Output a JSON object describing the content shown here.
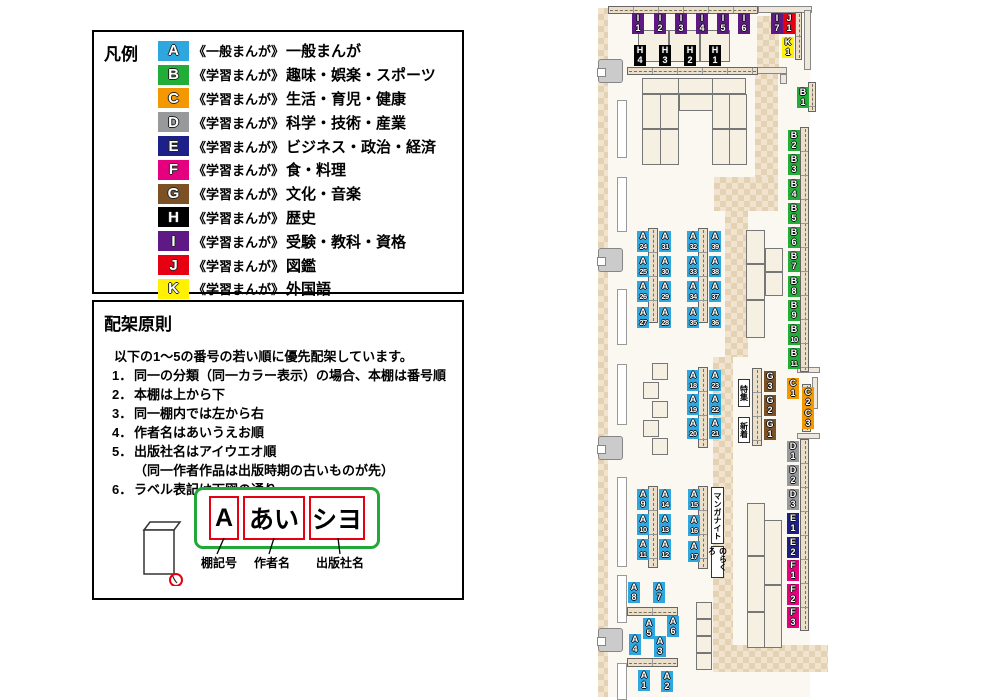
{
  "legend": {
    "title": "凡例",
    "items": [
      {
        "code": "A",
        "color": "#2EA7E0",
        "series": "《一般まんが》",
        "label": "一般まんが"
      },
      {
        "code": "B",
        "color": "#22AC38",
        "series": "《学習まんが》",
        "label": "趣味・娯楽・スポーツ"
      },
      {
        "code": "C",
        "color": "#F39800",
        "series": "《学習まんが》",
        "label": "生活・育児・健康"
      },
      {
        "code": "D",
        "color": "#98999A",
        "series": "《学習まんが》",
        "label": "科学・技術・産業"
      },
      {
        "code": "E",
        "color": "#1D2088",
        "series": "《学習まんが》",
        "label": "ビジネス・政治・経済"
      },
      {
        "code": "F",
        "color": "#E4007F",
        "series": "《学習まんが》",
        "label": "食・料理"
      },
      {
        "code": "G",
        "color": "#7D5126",
        "series": "《学習まんが》",
        "label": "文化・音楽"
      },
      {
        "code": "H",
        "color": "#000000",
        "series": "《学習まんが》",
        "label": "歴史"
      },
      {
        "code": "I",
        "color": "#5F1985",
        "series": "《学習まんが》",
        "label": "受験・教科・資格"
      },
      {
        "code": "J",
        "color": "#E60012",
        "series": "《学習まんが》",
        "label": "図鑑"
      },
      {
        "code": "K",
        "color": "#FFF100",
        "series": "《学習まんが》",
        "label": "外国語"
      }
    ]
  },
  "principles": {
    "title": "配架原則",
    "intro": "以下の1～5の番号の若い順に優先配架しています。",
    "rules": [
      {
        "num": "1．",
        "text": "同一の分類（同一カラー表示）の場合、本棚は番号順"
      },
      {
        "num": "2．",
        "text": "本棚は上から下"
      },
      {
        "num": "3．",
        "text": "同一棚内では左から右"
      },
      {
        "num": "4．",
        "text": "作者名はあいうえお順"
      },
      {
        "num": "5．",
        "text": "出版社名はアイウエオ順"
      },
      {
        "num": "",
        "text": "（同一作者作品は出版時期の古いものが先）"
      },
      {
        "num": "6．",
        "text": "ラベル表記は下図の通り"
      }
    ],
    "label_example": {
      "frame_color": "#21A838",
      "box_color": "#E60012",
      "parts": [
        {
          "text": "A",
          "caption": "棚記号"
        },
        {
          "text": "あい",
          "caption": "作者名"
        },
        {
          "text": "シヨ",
          "caption": "出版社名"
        }
      ]
    }
  },
  "map": {
    "palette": {
      "A": "#2EA7E0",
      "B": "#22AC38",
      "C": "#F39800",
      "D": "#98999A",
      "E": "#1D2088",
      "F": "#E4007F",
      "G": "#7D5126",
      "H": "#000000",
      "I": "#5F1985",
      "J": "#E60012",
      "K": "#FFF100"
    },
    "floor": [
      608,
      13,
      202,
      684
    ],
    "tiles": [
      [
        598,
        8,
        10,
        689
      ],
      [
        757,
        16,
        22,
        57
      ],
      [
        755,
        73,
        23,
        105
      ],
      [
        714,
        177,
        64,
        34
      ],
      [
        725,
        211,
        23,
        146
      ],
      [
        713,
        357,
        20,
        289
      ],
      [
        713,
        645,
        115,
        27
      ]
    ],
    "walls": [
      [
        758,
        6,
        54,
        7
      ],
      [
        804,
        10,
        7,
        60
      ],
      [
        757,
        67,
        30,
        7
      ],
      [
        780,
        74,
        7,
        10
      ],
      [
        797,
        367,
        23,
        6
      ],
      [
        812,
        377,
        6,
        32
      ],
      [
        797,
        433,
        23,
        6
      ]
    ],
    "wall_segments": [
      [
        617,
        100,
        10,
        58
      ],
      [
        617,
        177,
        10,
        55
      ],
      [
        617,
        289,
        10,
        56
      ],
      [
        617,
        364,
        10,
        61
      ],
      [
        617,
        477,
        10,
        90
      ],
      [
        617,
        575,
        10,
        48
      ],
      [
        617,
        663,
        10,
        37
      ]
    ],
    "doors": [
      [
        598,
        59
      ],
      [
        598,
        248
      ],
      [
        598,
        436
      ],
      [
        598,
        628
      ]
    ],
    "strips": [
      [
        608,
        6,
        150,
        8,
        "h"
      ],
      [
        627,
        67,
        131,
        8,
        "h"
      ],
      [
        795,
        12,
        7,
        48,
        "v"
      ],
      [
        808,
        82,
        8,
        30,
        "v"
      ],
      [
        800,
        127,
        9,
        245,
        "v"
      ],
      [
        802,
        384,
        9,
        48,
        "v"
      ],
      [
        800,
        439,
        9,
        192,
        "v"
      ],
      [
        648,
        228,
        10,
        95,
        "v"
      ],
      [
        698,
        228,
        10,
        95,
        "v"
      ],
      [
        698,
        367,
        10,
        81,
        "v"
      ],
      [
        752,
        368,
        10,
        78,
        "v"
      ],
      [
        648,
        486,
        10,
        82,
        "v"
      ],
      [
        698,
        486,
        10,
        83,
        "v"
      ],
      [
        627,
        607,
        51,
        9,
        "h"
      ],
      [
        627,
        658,
        51,
        9,
        "h"
      ]
    ],
    "tables": [
      [
        638,
        30,
        31,
        32
      ],
      [
        669,
        30,
        31,
        32
      ],
      [
        700,
        30,
        30,
        32
      ],
      [
        642,
        78,
        37,
        16
      ],
      [
        678,
        78,
        35,
        16
      ],
      [
        712,
        78,
        34,
        16
      ],
      [
        679,
        94,
        34,
        17
      ],
      [
        642,
        94,
        19,
        35
      ],
      [
        660,
        94,
        19,
        35
      ],
      [
        642,
        129,
        19,
        36
      ],
      [
        660,
        129,
        19,
        36
      ],
      [
        712,
        94,
        18,
        35
      ],
      [
        729,
        94,
        18,
        35
      ],
      [
        712,
        129,
        18,
        36
      ],
      [
        729,
        129,
        18,
        36
      ],
      [
        746,
        230,
        19,
        34
      ],
      [
        746,
        264,
        19,
        36
      ],
      [
        746,
        300,
        19,
        38
      ],
      [
        765,
        248,
        18,
        24
      ],
      [
        765,
        272,
        18,
        24
      ],
      [
        747,
        503,
        18,
        53
      ],
      [
        747,
        556,
        18,
        56
      ],
      [
        747,
        612,
        18,
        36
      ],
      [
        764,
        520,
        18,
        65
      ],
      [
        764,
        585,
        18,
        63
      ]
    ],
    "squares": [
      [
        652,
        363
      ],
      [
        643,
        382
      ],
      [
        652,
        401
      ],
      [
        643,
        420
      ],
      [
        652,
        438
      ],
      [
        696,
        602
      ],
      [
        696,
        619
      ],
      [
        696,
        636
      ],
      [
        696,
        653
      ]
    ],
    "shelf_labels": [
      {
        "t": "I1",
        "x": 632,
        "y": 13
      },
      {
        "t": "I2",
        "x": 654,
        "y": 13
      },
      {
        "t": "I3",
        "x": 675,
        "y": 13
      },
      {
        "t": "I4",
        "x": 696,
        "y": 13
      },
      {
        "t": "I5",
        "x": 717,
        "y": 13
      },
      {
        "t": "I6",
        "x": 738,
        "y": 13
      },
      {
        "t": "I7",
        "x": 771,
        "y": 13
      },
      {
        "t": "J1",
        "x": 783,
        "y": 13
      },
      {
        "t": "K1",
        "x": 782,
        "y": 37
      },
      {
        "t": "H4",
        "x": 634,
        "y": 45
      },
      {
        "t": "H3",
        "x": 659,
        "y": 45
      },
      {
        "t": "H2",
        "x": 684,
        "y": 45
      },
      {
        "t": "H1",
        "x": 709,
        "y": 45
      },
      {
        "t": "B1",
        "x": 797,
        "y": 87
      },
      {
        "t": "B2",
        "x": 788,
        "y": 130
      },
      {
        "t": "B3",
        "x": 788,
        "y": 154
      },
      {
        "t": "B4",
        "x": 788,
        "y": 179
      },
      {
        "t": "B5",
        "x": 788,
        "y": 203
      },
      {
        "t": "B6",
        "x": 788,
        "y": 227
      },
      {
        "t": "B7",
        "x": 788,
        "y": 251
      },
      {
        "t": "B8",
        "x": 788,
        "y": 276
      },
      {
        "t": "B9",
        "x": 788,
        "y": 300
      },
      {
        "t": "B10",
        "x": 788,
        "y": 324
      },
      {
        "t": "B11",
        "x": 788,
        "y": 348
      },
      {
        "t": "C1",
        "x": 787,
        "y": 378
      },
      {
        "t": "C2",
        "x": 802,
        "y": 387
      },
      {
        "t": "C3",
        "x": 802,
        "y": 408
      },
      {
        "t": "D1",
        "x": 787,
        "y": 441
      },
      {
        "t": "D2",
        "x": 787,
        "y": 465
      },
      {
        "t": "D3",
        "x": 787,
        "y": 489
      },
      {
        "t": "E1",
        "x": 787,
        "y": 513
      },
      {
        "t": "E2",
        "x": 787,
        "y": 537
      },
      {
        "t": "F1",
        "x": 787,
        "y": 560
      },
      {
        "t": "F2",
        "x": 787,
        "y": 584
      },
      {
        "t": "F3",
        "x": 787,
        "y": 607
      },
      {
        "t": "A24",
        "x": 637,
        "y": 231
      },
      {
        "t": "A31",
        "x": 659,
        "y": 231
      },
      {
        "t": "A25",
        "x": 637,
        "y": 256
      },
      {
        "t": "A30",
        "x": 659,
        "y": 256
      },
      {
        "t": "A26",
        "x": 637,
        "y": 281
      },
      {
        "t": "A29",
        "x": 659,
        "y": 281
      },
      {
        "t": "A27",
        "x": 637,
        "y": 307
      },
      {
        "t": "A28",
        "x": 659,
        "y": 307
      },
      {
        "t": "A32",
        "x": 687,
        "y": 231
      },
      {
        "t": "A39",
        "x": 709,
        "y": 231
      },
      {
        "t": "A33",
        "x": 687,
        "y": 256
      },
      {
        "t": "A38",
        "x": 709,
        "y": 256
      },
      {
        "t": "A34",
        "x": 687,
        "y": 281
      },
      {
        "t": "A37",
        "x": 709,
        "y": 281
      },
      {
        "t": "A35",
        "x": 687,
        "y": 307
      },
      {
        "t": "A36",
        "x": 709,
        "y": 307
      },
      {
        "t": "A18",
        "x": 687,
        "y": 370
      },
      {
        "t": "A23",
        "x": 709,
        "y": 370
      },
      {
        "t": "A19",
        "x": 687,
        "y": 394
      },
      {
        "t": "A22",
        "x": 709,
        "y": 394
      },
      {
        "t": "A20",
        "x": 687,
        "y": 418
      },
      {
        "t": "A21",
        "x": 709,
        "y": 418
      },
      {
        "t": "G3",
        "x": 764,
        "y": 371
      },
      {
        "t": "G2",
        "x": 764,
        "y": 395
      },
      {
        "t": "G1",
        "x": 764,
        "y": 419
      },
      {
        "t": "A9",
        "x": 637,
        "y": 489
      },
      {
        "t": "A14",
        "x": 659,
        "y": 489
      },
      {
        "t": "A10",
        "x": 637,
        "y": 514
      },
      {
        "t": "A13",
        "x": 659,
        "y": 514
      },
      {
        "t": "A11",
        "x": 637,
        "y": 539
      },
      {
        "t": "A12",
        "x": 659,
        "y": 539
      },
      {
        "t": "A15",
        "x": 688,
        "y": 489
      },
      {
        "t": "A16",
        "x": 688,
        "y": 515
      },
      {
        "t": "A17",
        "x": 688,
        "y": 541
      },
      {
        "t": "A8",
        "x": 628,
        "y": 582
      },
      {
        "t": "A7",
        "x": 653,
        "y": 582
      },
      {
        "t": "A5",
        "x": 643,
        "y": 618
      },
      {
        "t": "A6",
        "x": 667,
        "y": 616
      },
      {
        "t": "A4",
        "x": 629,
        "y": 634
      },
      {
        "t": "A3",
        "x": 654,
        "y": 636
      },
      {
        "t": "A1",
        "x": 638,
        "y": 670
      },
      {
        "t": "A2",
        "x": 661,
        "y": 671
      }
    ],
    "white_labels": [
      {
        "t": "特集",
        "x": 738,
        "y": 379,
        "w": 12,
        "h": 28
      },
      {
        "t": "新着",
        "x": 738,
        "y": 417,
        "w": 12,
        "h": 26
      },
      {
        "t": "マンガナイト",
        "x": 711,
        "y": 487,
        "w": 13,
        "h": 57
      },
      {
        "t": "のらくろ",
        "x": 711,
        "y": 546,
        "w": 13,
        "h": 32
      }
    ]
  }
}
